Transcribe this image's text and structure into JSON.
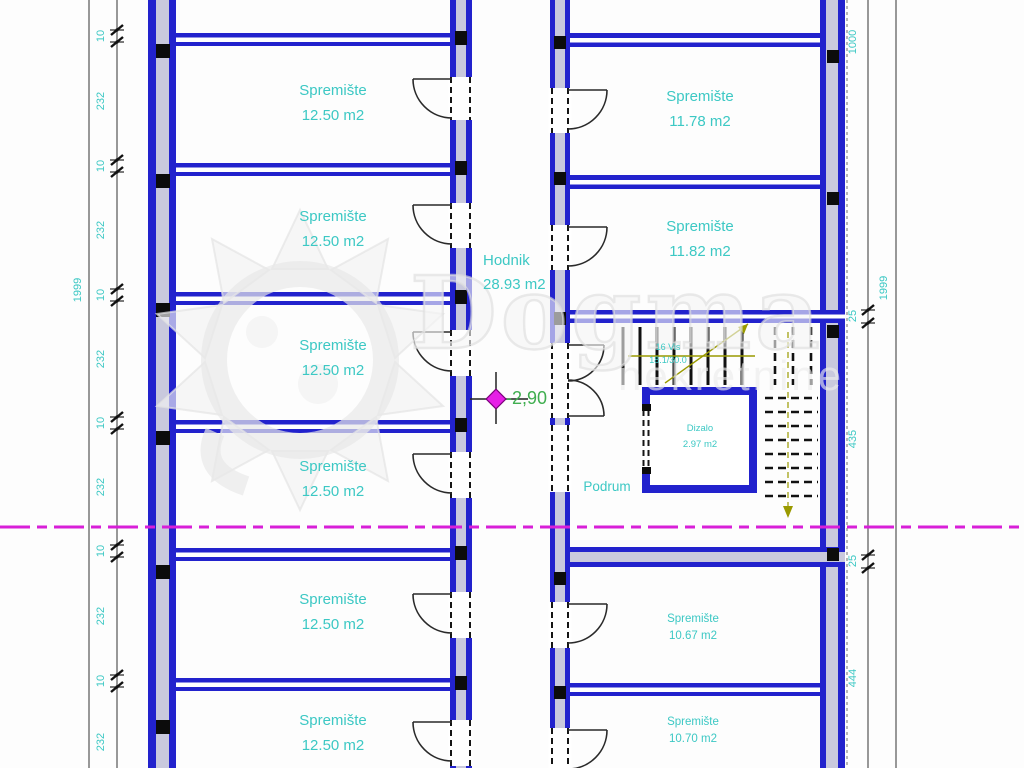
{
  "plan": {
    "corridor": {
      "name": "Hodnik",
      "area": "28.93 m2"
    },
    "left_rooms": [
      {
        "name": "Spremište",
        "area": "12.50 m2"
      },
      {
        "name": "Spremište",
        "area": "12.50 m2"
      },
      {
        "name": "Spremište",
        "area": "12.50 m2"
      },
      {
        "name": "Spremište",
        "area": "12.50 m2"
      },
      {
        "name": "Spremište",
        "area": "12.50 m2"
      },
      {
        "name": "Spremište",
        "area": "12.50 m2"
      }
    ],
    "right_rooms": [
      {
        "name": "Spremište",
        "area": "11.78 m2"
      },
      {
        "name": "Spremište",
        "area": "11.82 m2"
      },
      {
        "name": "Spremište",
        "area": "10.67 m2"
      },
      {
        "name": "Spremište",
        "area": "10.70 m2"
      }
    ],
    "elevator": {
      "name": "Dizalo",
      "area": "2.97 m2"
    },
    "labels": {
      "basement": "Podrum",
      "level": "-2,90"
    },
    "stairs": {
      "riser_count": "16 Vis",
      "riser_dims": "18.1/30.0"
    },
    "dimensions": {
      "left_total": "1999",
      "left_chain": [
        "10",
        "232",
        "10",
        "232",
        "10",
        "232",
        "10",
        "232",
        "10",
        "232",
        "10",
        "232"
      ],
      "right_total": "1999",
      "right_chain": [
        "1000",
        "25",
        "435",
        "25",
        "444"
      ]
    }
  },
  "watermark": {
    "name": "Dogma",
    "subtitle": "nekretnine"
  },
  "colors": {
    "wall": "#2222cd",
    "wall_core": "#c9c9dd",
    "label_text": "#3cc8c4",
    "level_text": "#3fae4f",
    "section_line": "#d81fd8",
    "stair_direction": "#9a9a00"
  }
}
